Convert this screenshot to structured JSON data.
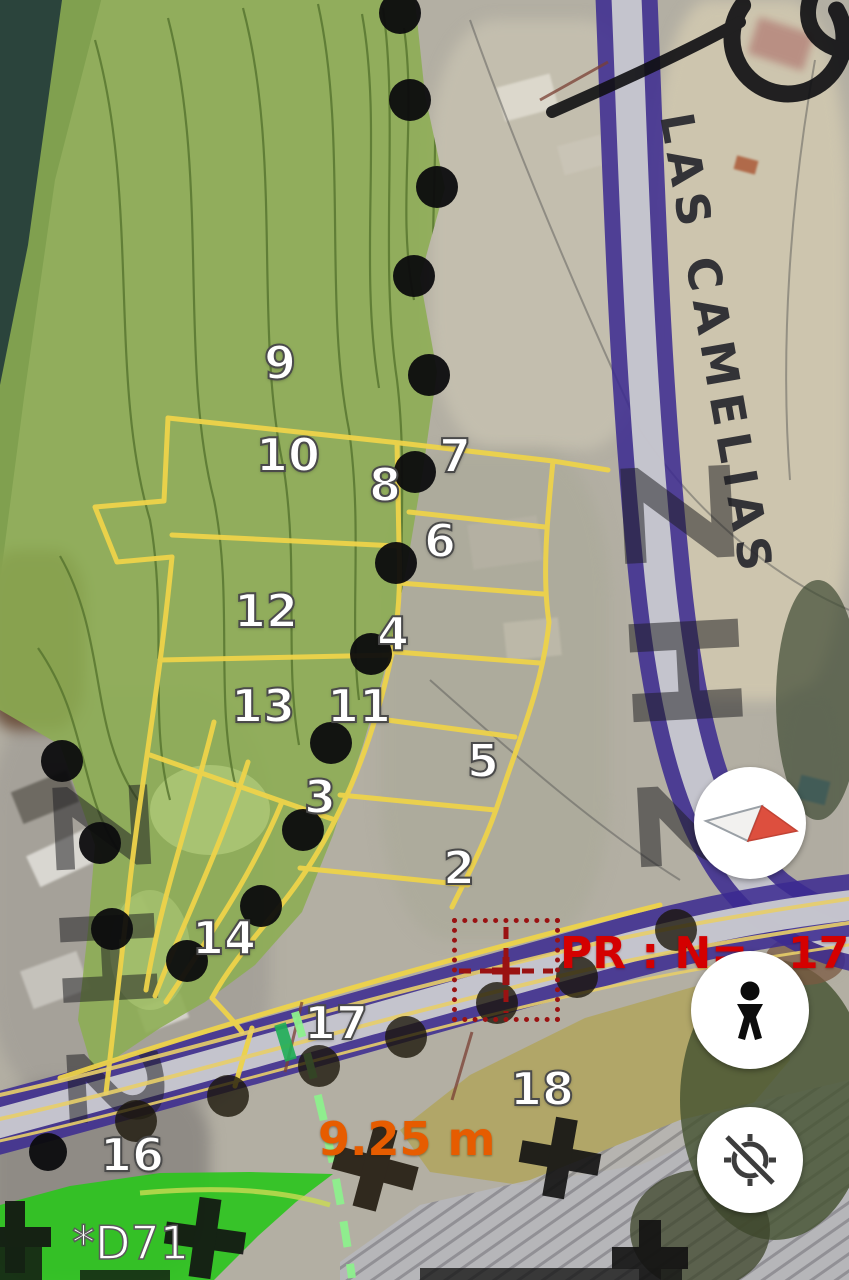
{
  "street_label": "LAS CAMELIAS",
  "zone_watermark": "ZH2",
  "zone_watermark_left": "ZH2",
  "pr_marker": {
    "prefix": "PR : N=",
    "suffix": "173"
  },
  "measurement_label": "9.25 m",
  "station_label": "*D71",
  "parcel_labels": [
    {
      "n": "9",
      "x": 280,
      "y": 363
    },
    {
      "n": "10",
      "x": 288,
      "y": 455
    },
    {
      "n": "7",
      "x": 455,
      "y": 456
    },
    {
      "n": "8",
      "x": 385,
      "y": 485
    },
    {
      "n": "6",
      "x": 440,
      "y": 541
    },
    {
      "n": "12",
      "x": 266,
      "y": 611
    },
    {
      "n": "4",
      "x": 393,
      "y": 634
    },
    {
      "n": "13",
      "x": 263,
      "y": 706
    },
    {
      "n": "11",
      "x": 359,
      "y": 706
    },
    {
      "n": "5",
      "x": 483,
      "y": 761
    },
    {
      "n": "3",
      "x": 320,
      "y": 797
    },
    {
      "n": "2",
      "x": 459,
      "y": 868
    },
    {
      "n": "14",
      "x": 224,
      "y": 938
    },
    {
      "n": "17",
      "x": 336,
      "y": 1023
    },
    {
      "n": "18",
      "x": 542,
      "y": 1089
    },
    {
      "n": "16",
      "x": 132,
      "y": 1155
    }
  ],
  "controls": {
    "compass_button": {
      "icon": "compass-needle-icon"
    },
    "street_view_button": {
      "icon": "pegman-icon"
    },
    "my_location_button": {
      "icon": "location-disabled-icon"
    }
  },
  "colors": {
    "parcel_line": "#eed34a",
    "road_casing": "#3b2a90",
    "green_zone": "#8cad52",
    "bright_green_zone": "#2cc41e",
    "khaki_zone": "#b0a24e",
    "pr_red": "#d40000",
    "measurement_orange": "#e65c00",
    "survey_dot": "#0b0b0d"
  }
}
